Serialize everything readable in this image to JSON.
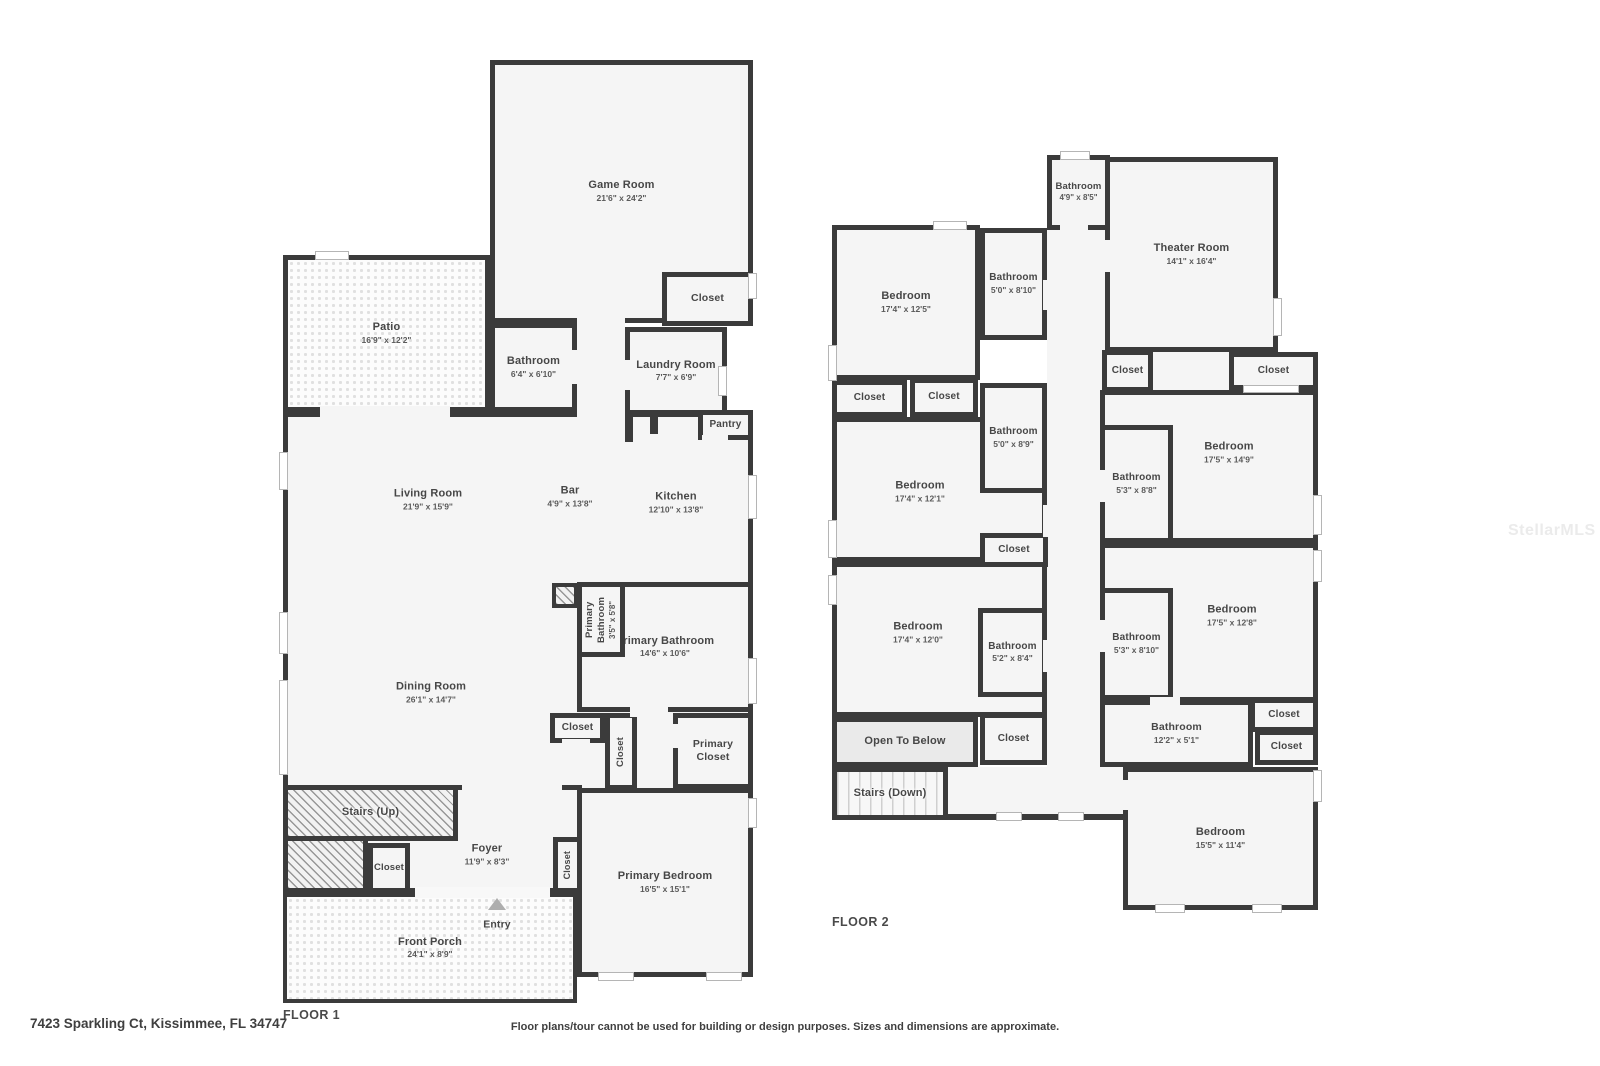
{
  "watermark": {
    "text": "StellarMLS",
    "color": "#ebebeb"
  },
  "footer": {
    "address": "7423 Sparkling Ct, Kissimmee, FL 34747",
    "disclaimer": "Floor plans/tour cannot be used for building or design purposes. Sizes and dimensions are approximate."
  },
  "colors": {
    "wall": "#3b3b3b",
    "room_fill": "#f5f5f5",
    "label": "#474747",
    "background": "#ffffff"
  },
  "floor1": {
    "label": "FLOOR 1",
    "rooms": {
      "game_room": {
        "name": "Game Room",
        "dims": "21'6\" x 24'2\""
      },
      "closet_game": {
        "name": "Closet"
      },
      "patio": {
        "name": "Patio",
        "dims": "16'9\" x 12'2\""
      },
      "bathroom": {
        "name": "Bathroom",
        "dims": "6'4\" x 6'10\""
      },
      "laundry": {
        "name": "Laundry Room",
        "dims": "7'7\" x 6'9\""
      },
      "pantry": {
        "name": "Pantry"
      },
      "living": {
        "name": "Living Room",
        "dims": "21'9\" x 15'9\""
      },
      "bar": {
        "name": "Bar",
        "dims": "4'9\" x 13'8\""
      },
      "kitchen": {
        "name": "Kitchen",
        "dims": "12'10\" x 13'8\""
      },
      "primary_bath_small": {
        "name": "Primary Bathroom",
        "dims": "3'5\" x 5'8\""
      },
      "primary_bath": {
        "name": "Primary Bathroom",
        "dims": "14'6\" x 10'6\""
      },
      "dining": {
        "name": "Dining Room",
        "dims": "26'1\" x 14'7\""
      },
      "closet_a": {
        "name": "Closet"
      },
      "closet_b": {
        "name": "Closet"
      },
      "primary_closet": {
        "name": "Primary Closet"
      },
      "stairs_up": {
        "name": "Stairs (Up)"
      },
      "closet_foyer": {
        "name": "Closet"
      },
      "foyer": {
        "name": "Foyer",
        "dims": "11'9\" x 8'3\""
      },
      "closet_vert": {
        "name": "Closet"
      },
      "primary_bedroom": {
        "name": "Primary Bedroom",
        "dims": "16'5\" x 15'1\""
      },
      "entry": {
        "name": "Entry"
      },
      "front_porch": {
        "name": "Front Porch",
        "dims": "24'1\" x 8'9\""
      }
    }
  },
  "floor2": {
    "label": "FLOOR 2",
    "rooms": {
      "bathroom_top": {
        "name": "Bathroom",
        "dims": "4'9\" x 8'5\""
      },
      "theater": {
        "name": "Theater Room",
        "dims": "14'1\" x 16'4\""
      },
      "bedroom_tl": {
        "name": "Bedroom",
        "dims": "17'4\" x 12'5\""
      },
      "bathroom_a": {
        "name": "Bathroom",
        "dims": "5'0\" x 8'10\""
      },
      "closet_mid": {
        "name": "Closet"
      },
      "closet_right": {
        "name": "Closet"
      },
      "closet_c1": {
        "name": "Closet"
      },
      "closet_c2": {
        "name": "Closet"
      },
      "bathroom_b": {
        "name": "Bathroom",
        "dims": "5'0\" x 8'9\""
      },
      "bedroom_ml": {
        "name": "Bedroom",
        "dims": "17'4\" x 12'1\""
      },
      "bathroom_c": {
        "name": "Bathroom",
        "dims": "5'3\" x 8'8\""
      },
      "bedroom_ra": {
        "name": "Bedroom",
        "dims": "17'5\" x 14'9\""
      },
      "closet_mid2": {
        "name": "Closet"
      },
      "bedroom_bl": {
        "name": "Bedroom",
        "dims": "17'4\" x 12'0\""
      },
      "bathroom_d": {
        "name": "Bathroom",
        "dims": "5'2\" x 8'4\""
      },
      "bathroom_e": {
        "name": "Bathroom",
        "dims": "5'3\" x 8'10\""
      },
      "bedroom_rb": {
        "name": "Bedroom",
        "dims": "17'5\" x 12'8\""
      },
      "open_below": {
        "name": "Open To Below"
      },
      "closet_d": {
        "name": "Closet"
      },
      "stairs_down": {
        "name": "Stairs (Down)"
      },
      "bathroom_f": {
        "name": "Bathroom",
        "dims": "12'2\" x 5'1\""
      },
      "closet_e": {
        "name": "Closet"
      },
      "closet_f": {
        "name": "Closet"
      },
      "bedroom_br": {
        "name": "Bedroom",
        "dims": "15'5\" x 11'4\""
      }
    }
  }
}
